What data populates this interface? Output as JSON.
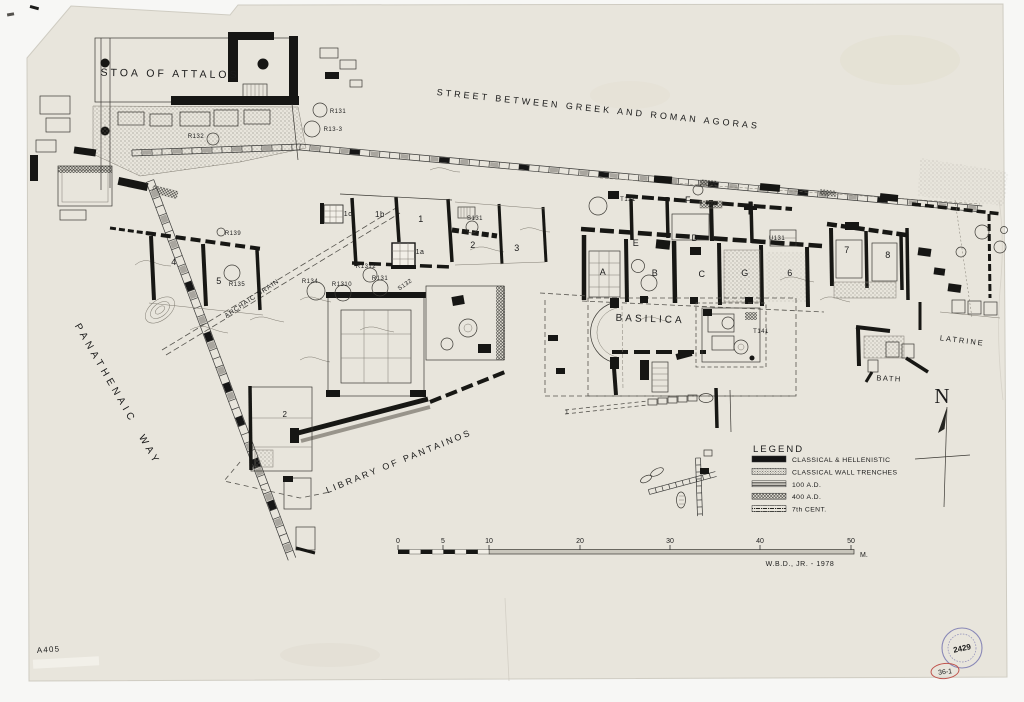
{
  "sheet": {
    "number": "A405",
    "stamp_number": "2429",
    "red_mark": "36-1"
  },
  "north": {
    "label": "N"
  },
  "scale_bar": {
    "ticks": [
      {
        "label": "0",
        "x": 398
      },
      {
        "label": "5",
        "x": 443
      },
      {
        "label": "10",
        "x": 489
      },
      {
        "label": "20",
        "x": 580
      },
      {
        "label": "30",
        "x": 670
      },
      {
        "label": "40",
        "x": 760
      },
      {
        "label": "50",
        "x": 851
      }
    ],
    "unit": "M.",
    "credit": "W.B.D., JR. - 1978"
  },
  "legend": {
    "title": "LEGEND",
    "items": [
      {
        "label": "CLASSICAL & HELLENISTIC",
        "style": "solid"
      },
      {
        "label": "CLASSICAL WALL TRENCHES",
        "style": "stipple"
      },
      {
        "label": "100 A.D.",
        "style": "hlines"
      },
      {
        "label": "400 A.D.",
        "style": "crosshatch"
      },
      {
        "label": "7th CENT.",
        "style": "dashdot"
      }
    ]
  },
  "title_labels": [
    {
      "text": "STOA OF ATTALOS",
      "x": 170,
      "y": 77,
      "rot": 1,
      "fs": 10.5,
      "ls": 3,
      "name": "stoa-of-attalos-label"
    },
    {
      "text": "STREET BETWEEN GREEK AND ROMAN AGORAS",
      "x": 598,
      "y": 112,
      "rot": 6,
      "fs": 9,
      "ls": 3,
      "name": "street-between-agoras-label"
    },
    {
      "text": "PANATHENAIC WAY",
      "x": 115,
      "y": 396,
      "rot": 60,
      "fs": 10,
      "ls": 4,
      "ws": 8,
      "name": "panathenaic-way-label"
    },
    {
      "text": "LIBRARY OF PANTAINOS",
      "x": 400,
      "y": 464,
      "rot": -22,
      "fs": 9,
      "ls": 2.5,
      "name": "library-of-pantainos-label"
    },
    {
      "text": "BASILICA",
      "x": 650,
      "y": 322,
      "rot": 2,
      "fs": 10,
      "ls": 3,
      "name": "basilica-label"
    },
    {
      "text": "LATRINE",
      "x": 962,
      "y": 343,
      "rot": 7,
      "fs": 7.5,
      "ls": 2,
      "name": "latrine-label"
    },
    {
      "text": "BATH",
      "x": 889,
      "y": 381,
      "rot": 3,
      "fs": 7.5,
      "ls": 1.5,
      "name": "bath-label"
    },
    {
      "text": "ARCHAIC DRAIN",
      "x": 253,
      "y": 300,
      "rot": -34,
      "fs": 6.5,
      "ls": 1,
      "name": "archaic-drain-label"
    }
  ],
  "room_labels": [
    {
      "text": "1c",
      "x": 348,
      "y": 216,
      "fs": 7
    },
    {
      "text": "1b",
      "x": 380,
      "y": 217,
      "fs": 8
    },
    {
      "text": "1",
      "x": 421,
      "y": 222,
      "fs": 9
    },
    {
      "text": "1a",
      "x": 420,
      "y": 254,
      "fs": 7
    },
    {
      "text": "2",
      "x": 473,
      "y": 248,
      "fs": 9
    },
    {
      "text": "3",
      "x": 517,
      "y": 251,
      "fs": 9
    },
    {
      "text": "4",
      "x": 174,
      "y": 265,
      "fs": 9
    },
    {
      "text": "5",
      "x": 219,
      "y": 284,
      "fs": 9
    },
    {
      "text": "A",
      "x": 603,
      "y": 275,
      "fs": 9
    },
    {
      "text": "B",
      "x": 655,
      "y": 276,
      "fs": 9
    },
    {
      "text": "C",
      "x": 702,
      "y": 277,
      "fs": 9
    },
    {
      "text": "G",
      "x": 745,
      "y": 276,
      "fs": 9
    },
    {
      "text": "6",
      "x": 790,
      "y": 276,
      "fs": 9
    },
    {
      "text": "7",
      "x": 847,
      "y": 253,
      "fs": 9
    },
    {
      "text": "8",
      "x": 888,
      "y": 258,
      "fs": 9
    },
    {
      "text": "D",
      "x": 695,
      "y": 241,
      "fs": 9
    },
    {
      "text": "E",
      "x": 636,
      "y": 246,
      "fs": 9
    },
    {
      "text": "F",
      "x": 688,
      "y": 203,
      "fs": 9
    },
    {
      "text": "2",
      "x": 285,
      "y": 417,
      "fs": 8
    },
    {
      "text": "1",
      "x": 567,
      "y": 414,
      "fs": 6
    }
  ],
  "deposit_labels": [
    {
      "text": "R132",
      "x": 196,
      "y": 138
    },
    {
      "text": "R131",
      "x": 338,
      "y": 113
    },
    {
      "text": "R13-3",
      "x": 333,
      "y": 131
    },
    {
      "text": "R139",
      "x": 233,
      "y": 235
    },
    {
      "text": "R135",
      "x": 237,
      "y": 286
    },
    {
      "text": "R134",
      "x": 310,
      "y": 283
    },
    {
      "text": "R1310",
      "x": 342,
      "y": 286
    },
    {
      "text": "R1312",
      "x": 366,
      "y": 268
    },
    {
      "text": "R131",
      "x": 380,
      "y": 280
    },
    {
      "text": "S132",
      "x": 406,
      "y": 286,
      "rot": -35
    },
    {
      "text": "S131",
      "x": 475,
      "y": 220
    },
    {
      "text": "T131",
      "x": 628,
      "y": 201
    },
    {
      "text": "T141",
      "x": 761,
      "y": 333
    },
    {
      "text": "U131",
      "x": 777,
      "y": 240
    }
  ]
}
